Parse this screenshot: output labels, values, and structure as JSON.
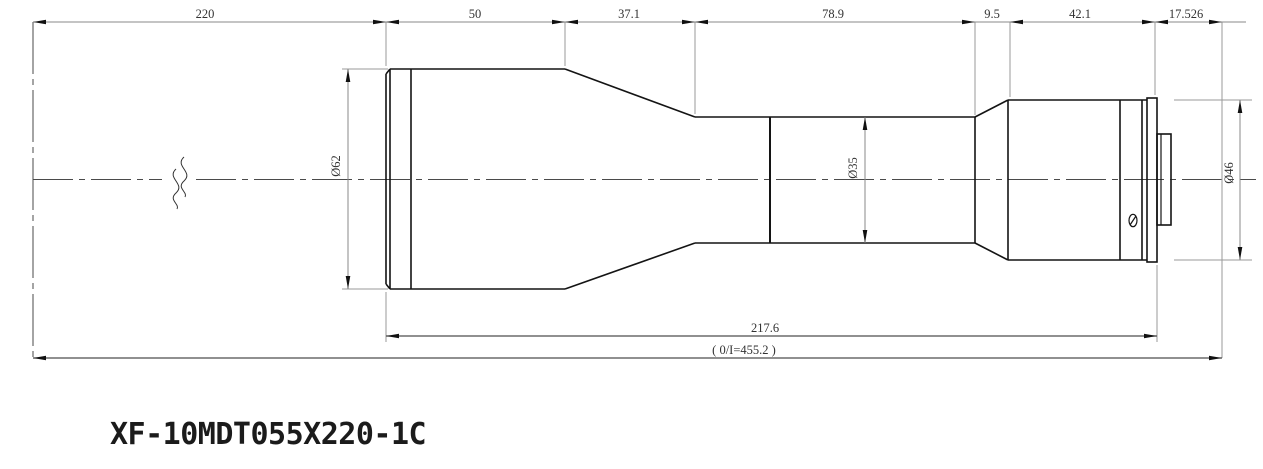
{
  "drawing": {
    "title": "XF-10MDT055X220-1C",
    "top_dimensions": [
      {
        "name": "object-distance",
        "label": "220",
        "value": 220
      },
      {
        "name": "front-cylinder-length",
        "label": "50",
        "value": 50
      },
      {
        "name": "taper-length",
        "label": "37.1",
        "value": 37.1
      },
      {
        "name": "mid-tube-length",
        "label": "78.9",
        "value": 78.9
      },
      {
        "name": "rear-taper-length",
        "label": "9.5",
        "value": 9.5
      },
      {
        "name": "rear-barrel-length",
        "label": "42.1",
        "value": 42.1
      },
      {
        "name": "flange-focal-distance",
        "label": "17.526",
        "value": 17.526
      }
    ],
    "diameter_dimensions": [
      {
        "name": "front-diameter",
        "label": "Ø62",
        "value": 62
      },
      {
        "name": "mid-diameter",
        "label": "Ø35",
        "value": 35
      },
      {
        "name": "rear-diameter",
        "label": "Ø46",
        "value": 46
      }
    ],
    "bottom_dimensions": {
      "lens_length_label": "217.6",
      "lens_length_value": 217.6,
      "object_image_label": "( 0/I=455.2 )",
      "object_image_value": 455.2
    }
  }
}
